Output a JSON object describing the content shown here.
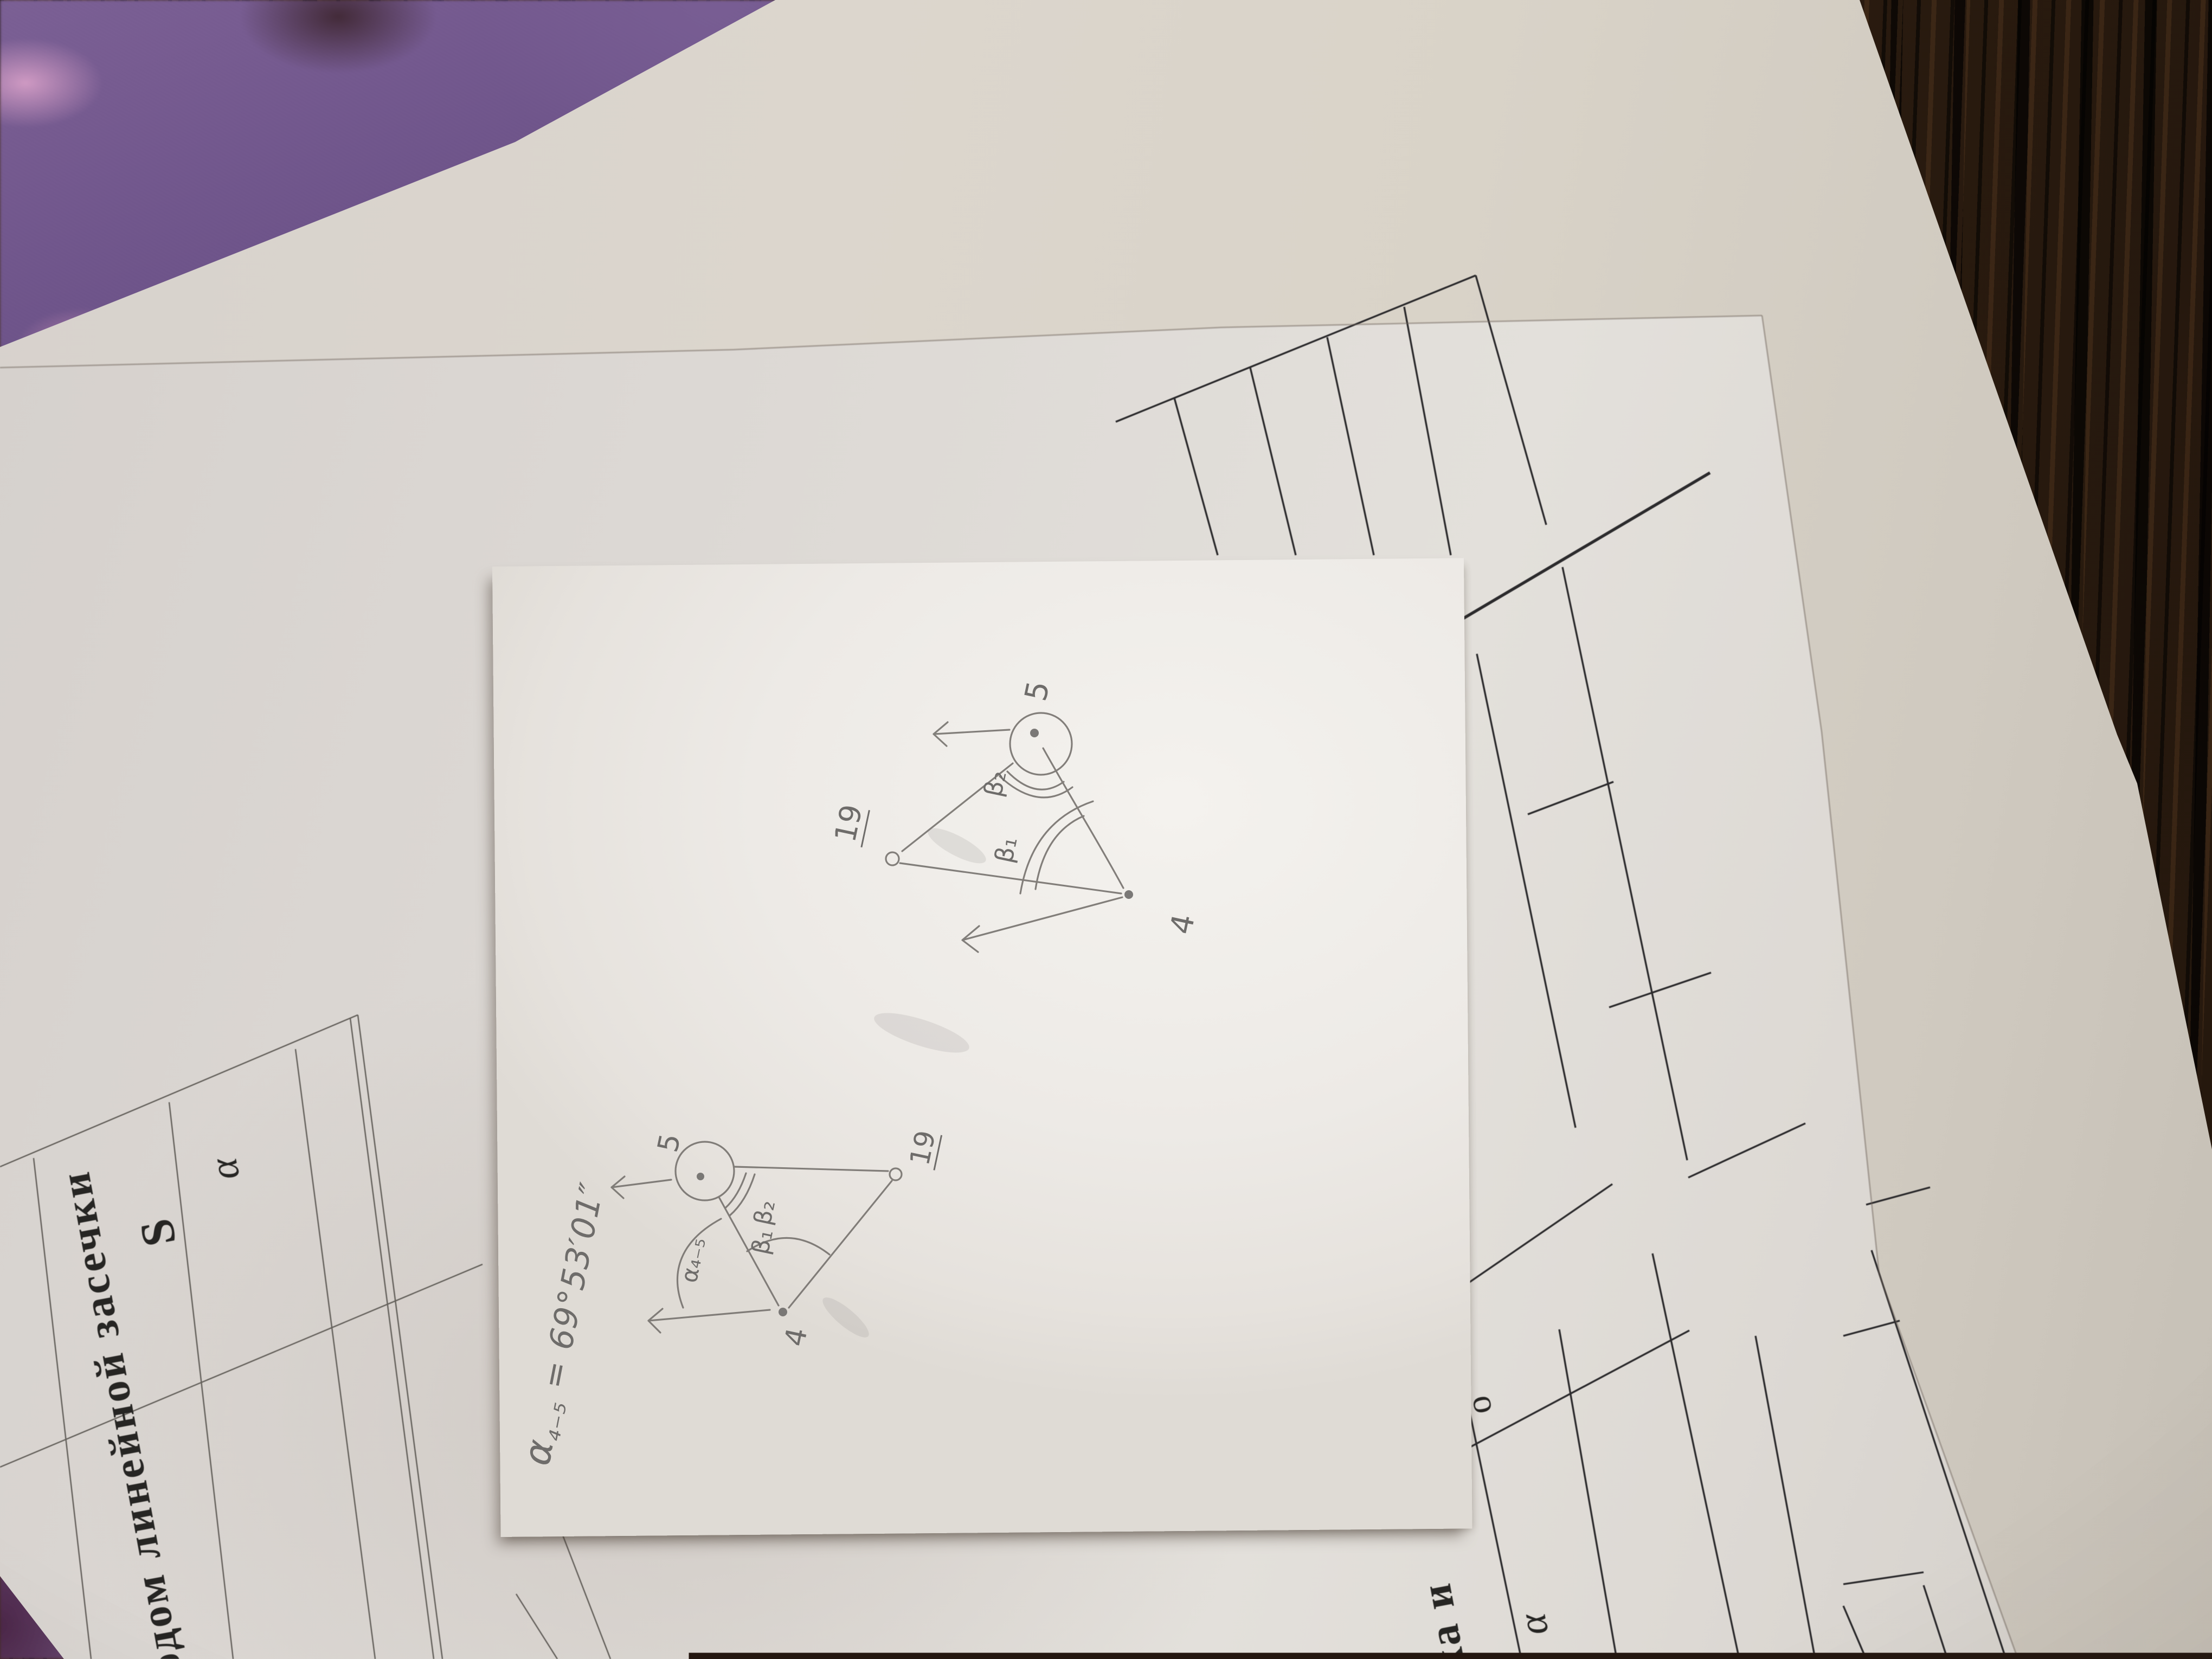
{
  "scene": {
    "printed_sheet": {
      "title_fragment": "одом линейной засечки",
      "table_left": {
        "header_s": "S",
        "header_alpha": "α"
      },
      "section2_fragment": "тка и",
      "section2_partial_letter": "о",
      "table_right": {
        "header_alpha": "α"
      },
      "corner_partial_letter": "Т"
    },
    "sticky_note": {
      "formula": {
        "alpha": "α",
        "subscript": "₄₋₅",
        "value": " = 69°53′01″"
      },
      "sketch_small": {
        "point_top": "5",
        "point_right": "19",
        "point_bottom": "4",
        "angle_direction": "α₄₋₅",
        "angle_b1": "β₁",
        "angle_b2": "β₂"
      },
      "sketch_large": {
        "point_top": "5",
        "point_left": "19",
        "point_bottom": "4",
        "angle_b1": "β₁",
        "angle_b2": "β₂"
      }
    },
    "colors": {
      "print_ink": "#2c2b2d",
      "pencil": "#76726e",
      "thin_line": "#5a5651"
    }
  }
}
